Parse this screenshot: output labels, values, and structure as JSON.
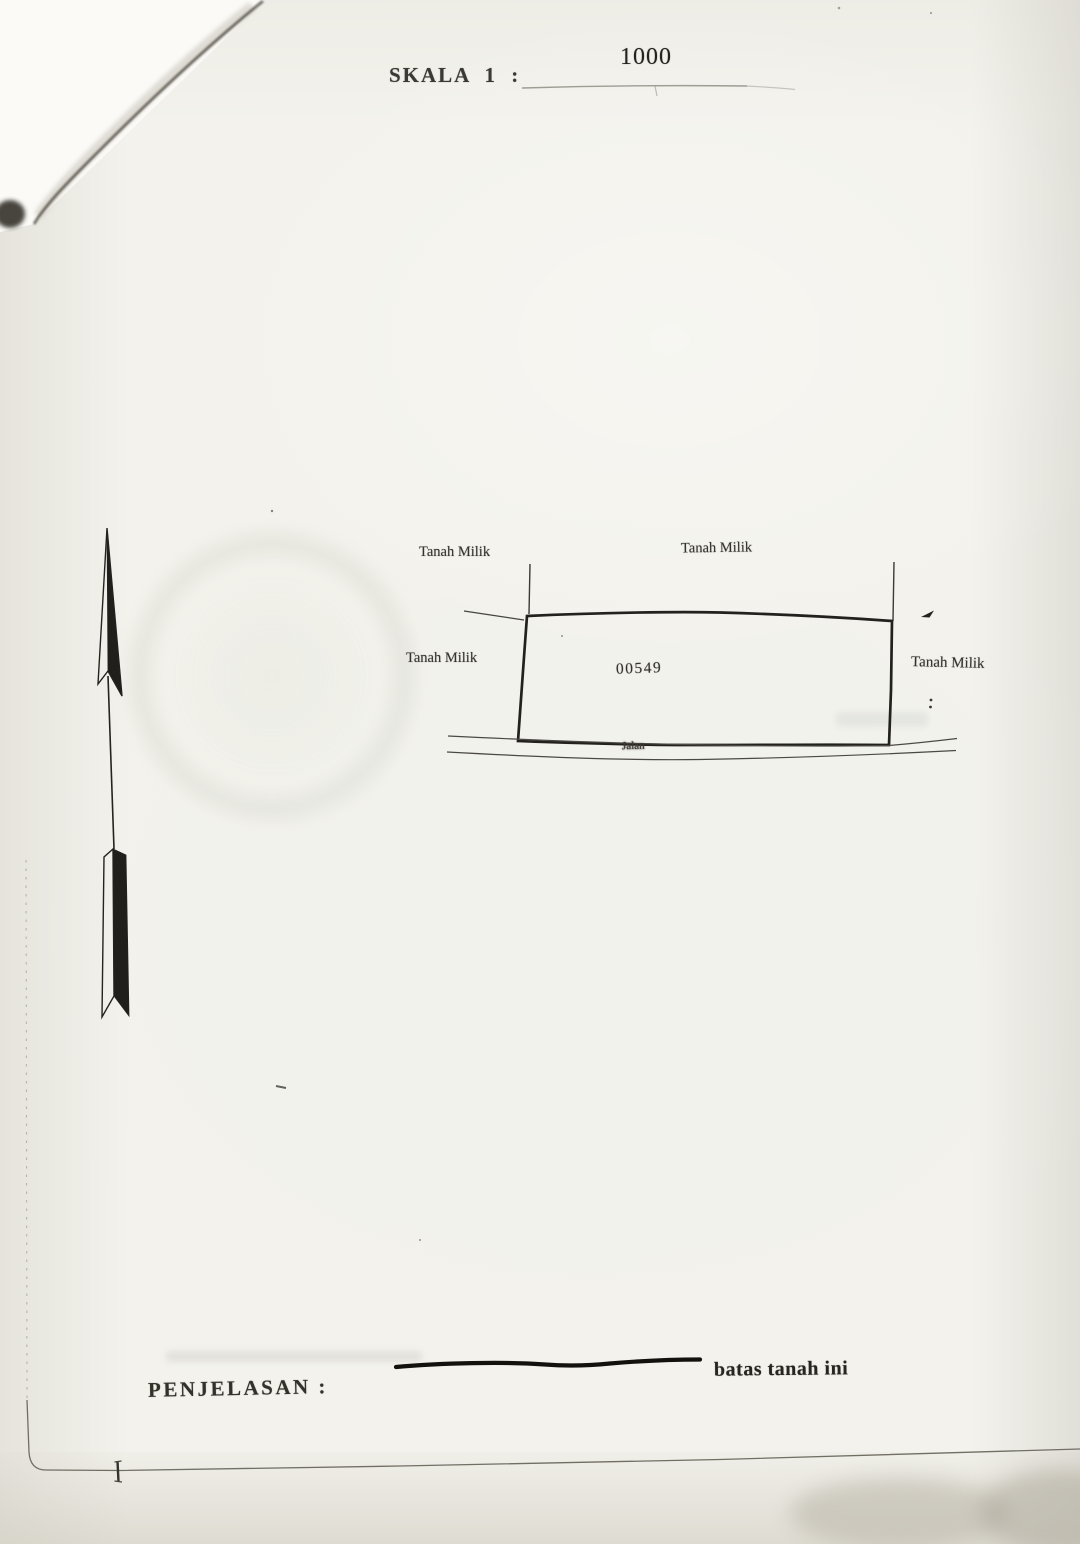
{
  "header": {
    "scale_label": "SKALA 1 :",
    "scale_value": "1000"
  },
  "sketch": {
    "parcel_number": "00549",
    "road_label": "Jalan",
    "neighbor_top_left": "Tanah Milik",
    "neighbor_top_center": "Tanah Milik",
    "neighbor_left": "Tanah Milik",
    "neighbor_right": "Tanah Milik",
    "north_arrow_icon": "north-arrow-icon"
  },
  "legend": {
    "label": "PENJELASAN :",
    "boundary_line_label": "batas tanah ini"
  },
  "colors": {
    "paper": "#f3f2ec",
    "ink": "#2b2a26",
    "boundary_line": "#22211d"
  }
}
